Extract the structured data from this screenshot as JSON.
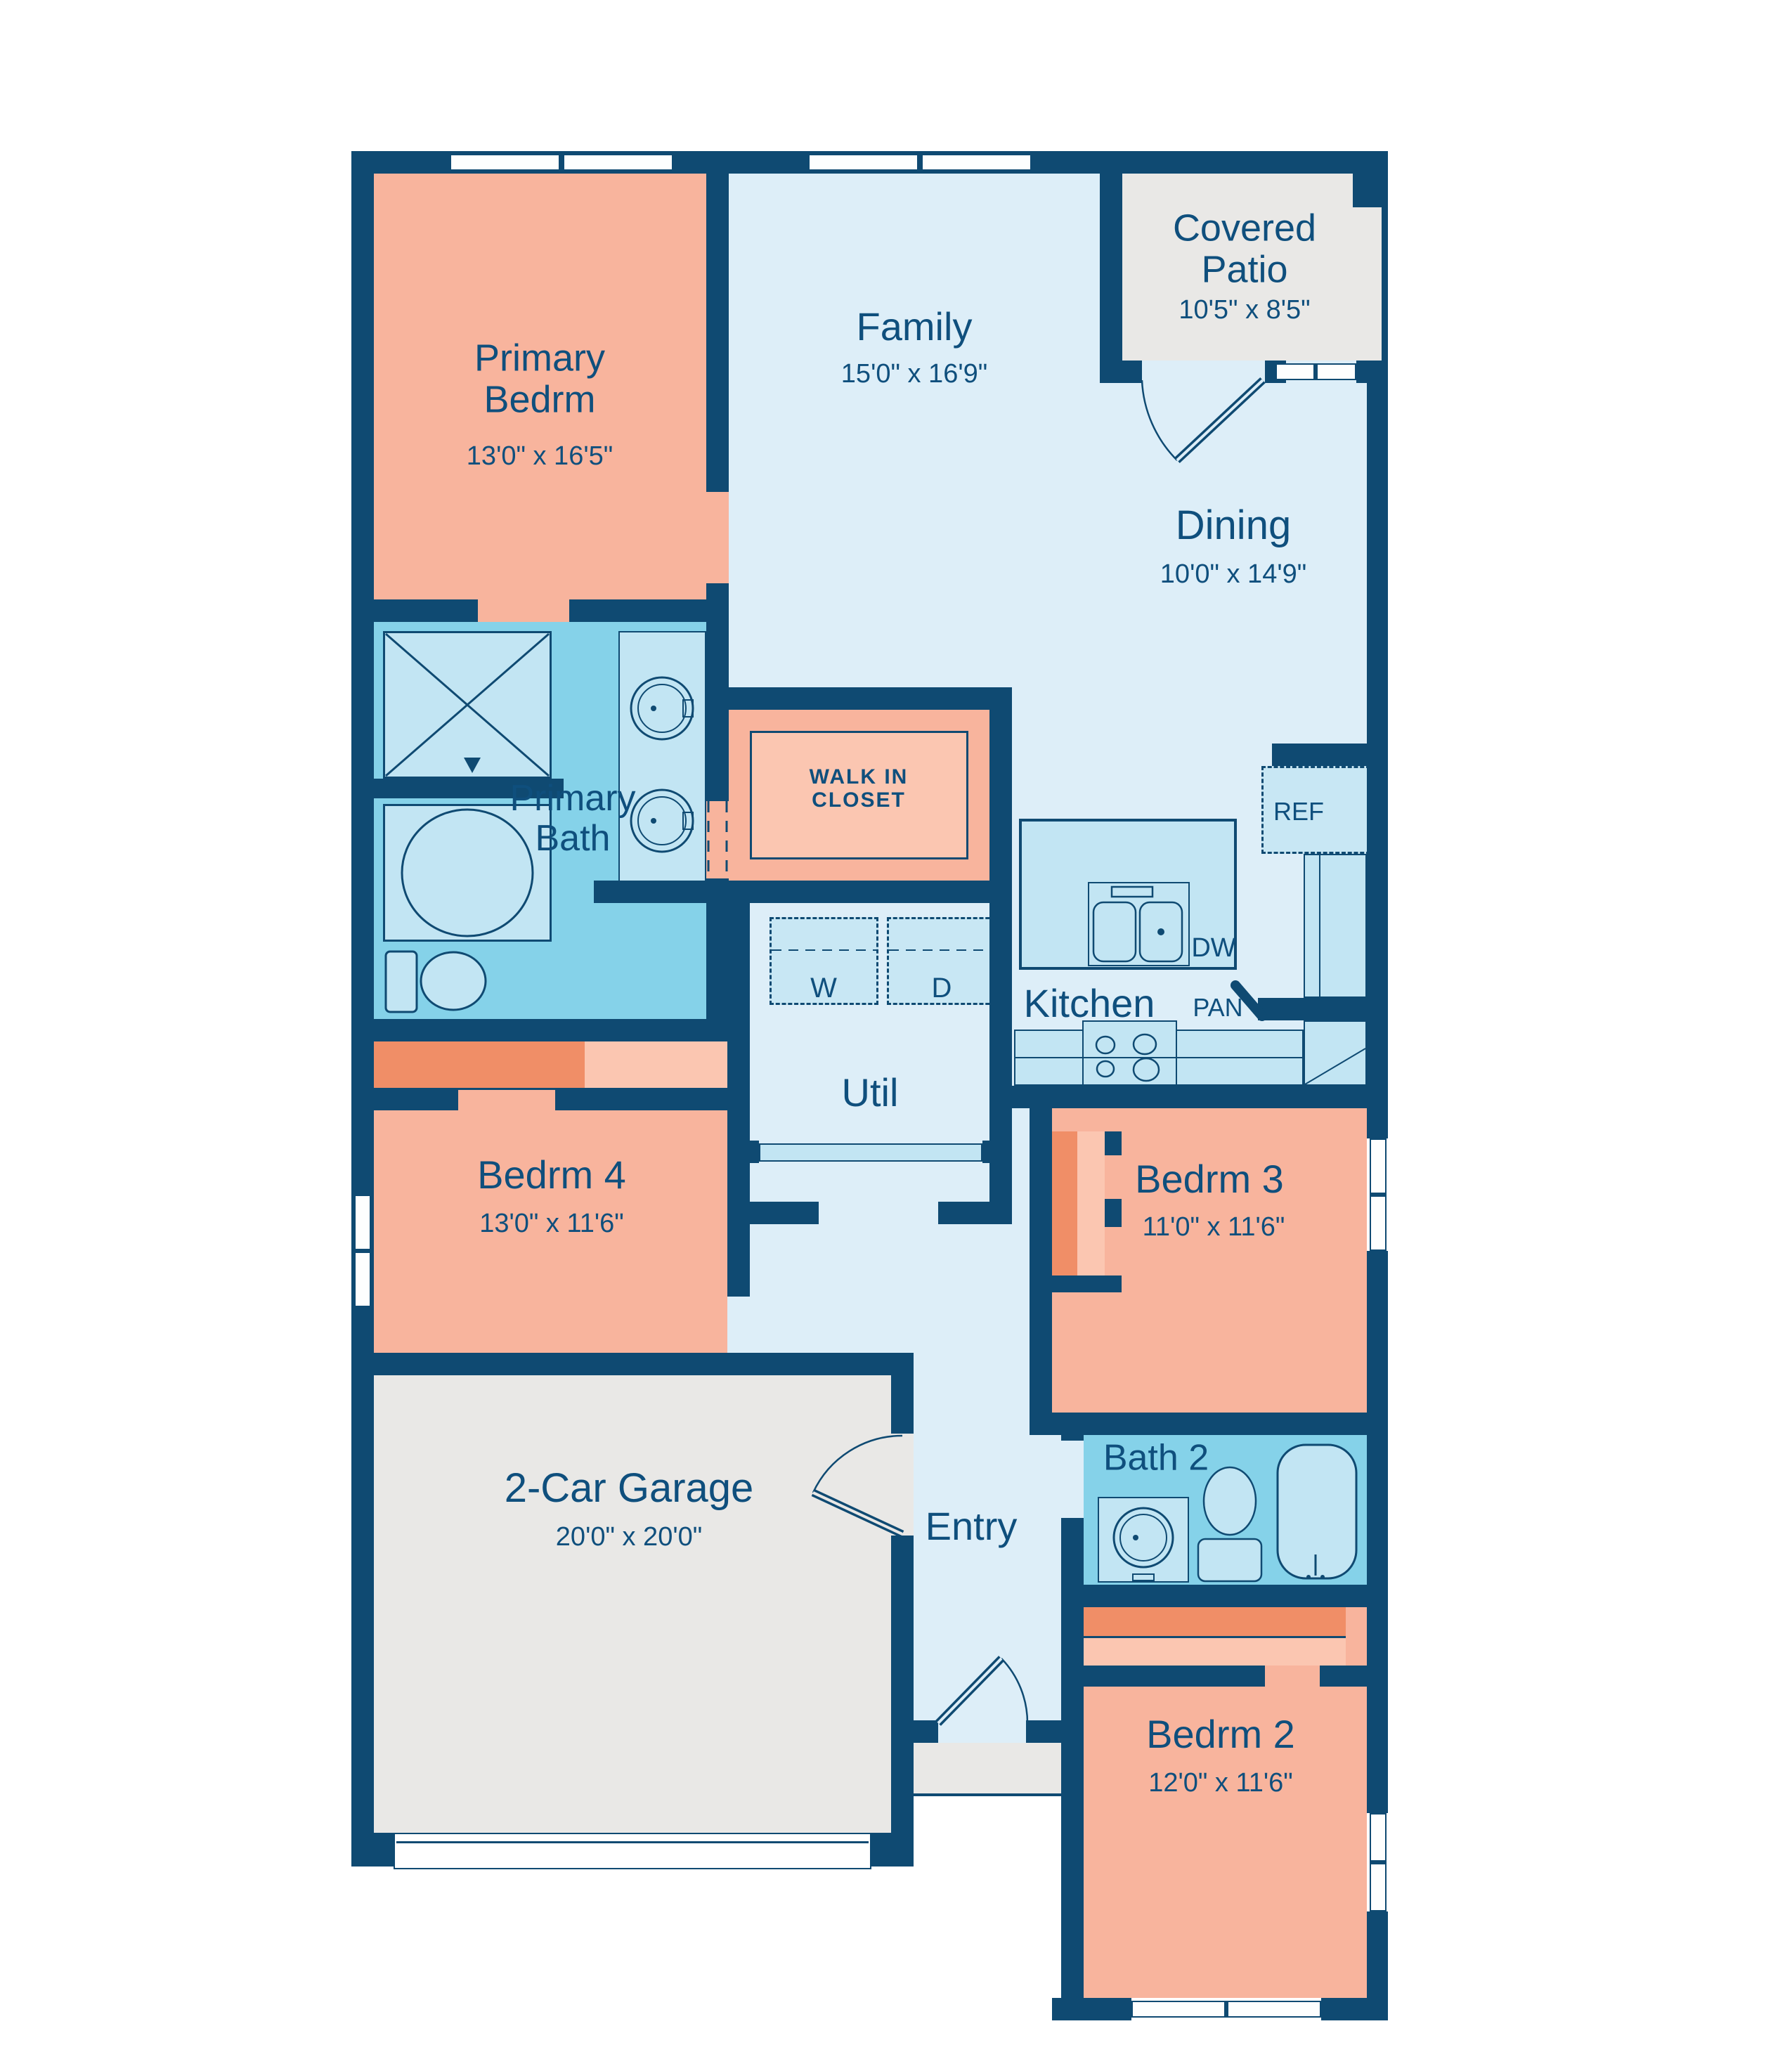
{
  "rooms": {
    "primary_bedroom": {
      "name": "Primary Bedrm",
      "dims": "13'0\" x 16'5\""
    },
    "family": {
      "name": "Family",
      "dims": "15'0\" x 16'9\""
    },
    "covered_patio": {
      "name": "Covered Patio",
      "dims": "10'5\" x 8'5\""
    },
    "dining": {
      "name": "Dining",
      "dims": "10'0\" x 14'9\""
    },
    "primary_bath": {
      "name": "Primary Bath"
    },
    "walk_in_closet": {
      "name": "WALK IN CLOSET"
    },
    "bedroom4": {
      "name": "Bedrm 4",
      "dims": "13'0\" x 11'6\""
    },
    "utility": {
      "name": "Util"
    },
    "kitchen": {
      "name": "Kitchen"
    },
    "bedroom3": {
      "name": "Bedrm 3",
      "dims": "11'0\" x 11'6\""
    },
    "bath2": {
      "name": "Bath 2"
    },
    "garage": {
      "name": "2-Car Garage",
      "dims": "20'0\" x 20'0\""
    },
    "entry": {
      "name": "Entry"
    },
    "bedroom2": {
      "name": "Bedrm 2",
      "dims": "12'0\" x 11'6\""
    }
  },
  "appliances": {
    "refrigerator": "REF",
    "pantry": "PAN",
    "dishwasher": "DW",
    "washer": "W",
    "dryer": "D"
  },
  "colors": {
    "wall": "#0f4a72",
    "floor_blue": "#ddeef8",
    "bath_blue": "#85d2e9",
    "fixture_blue": "#c2e5f3",
    "room_salmon": "#f8b49d",
    "closet_dark": "#f08e67",
    "closet_light": "#fbc6b1",
    "outdoor_gray": "#e9e8e6",
    "text": "#0f4f7d"
  }
}
